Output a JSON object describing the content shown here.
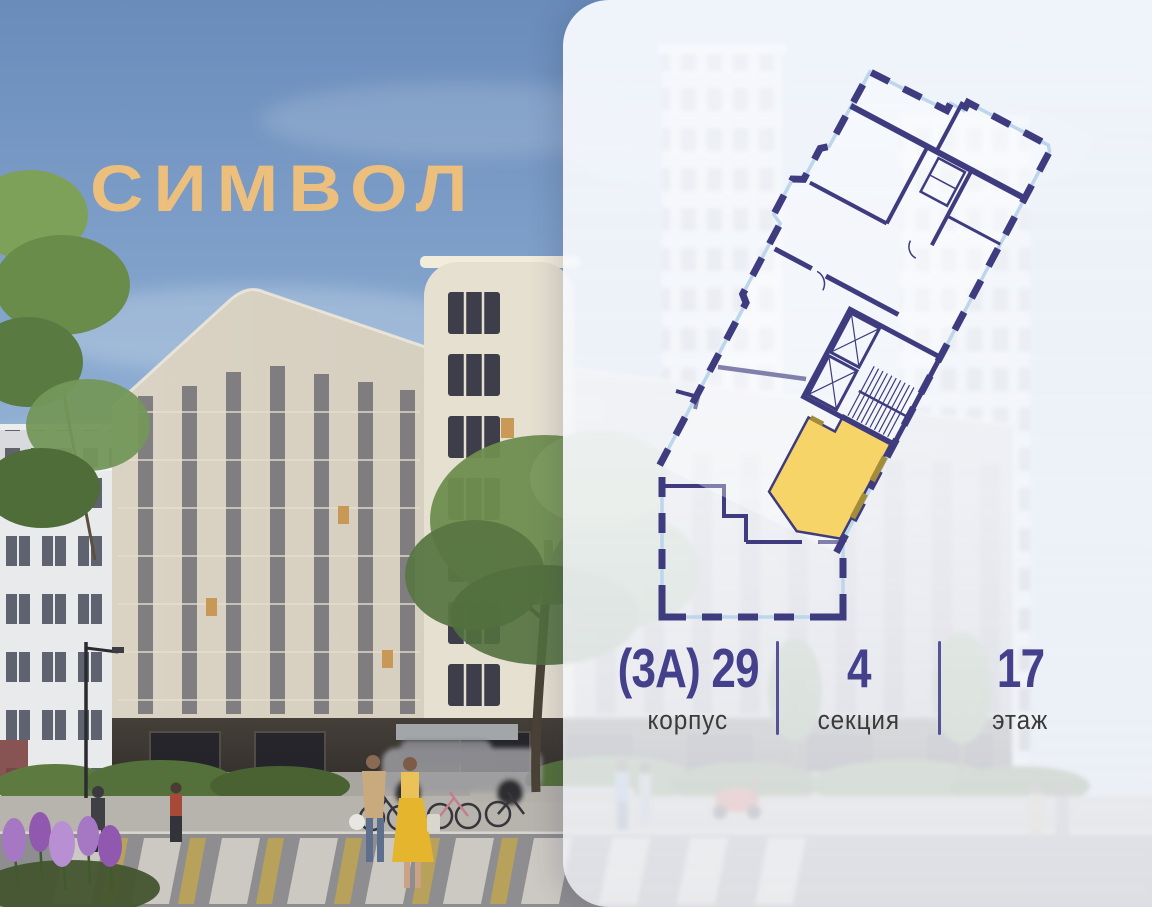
{
  "logo": {
    "text": "СИМВОЛ",
    "color": "#ecbf7c"
  },
  "panel": {
    "background": "#f6f8fb"
  },
  "floorplan": {
    "wall_color": "#3e3b7e",
    "glass_color": "#bcd6ec",
    "highlight_color": "#f6d468",
    "balcony_accent_color": "#a38d3a",
    "highlighted_unit": "selected apartment"
  },
  "info": {
    "value_color": "#45408c",
    "label_color": "#3a3a3a",
    "divider_color": "#4b4490",
    "items": [
      {
        "value": "(3А) 29",
        "label": "корпус"
      },
      {
        "value": "4",
        "label": "секция"
      },
      {
        "value": "17",
        "label": "этаж"
      }
    ]
  }
}
